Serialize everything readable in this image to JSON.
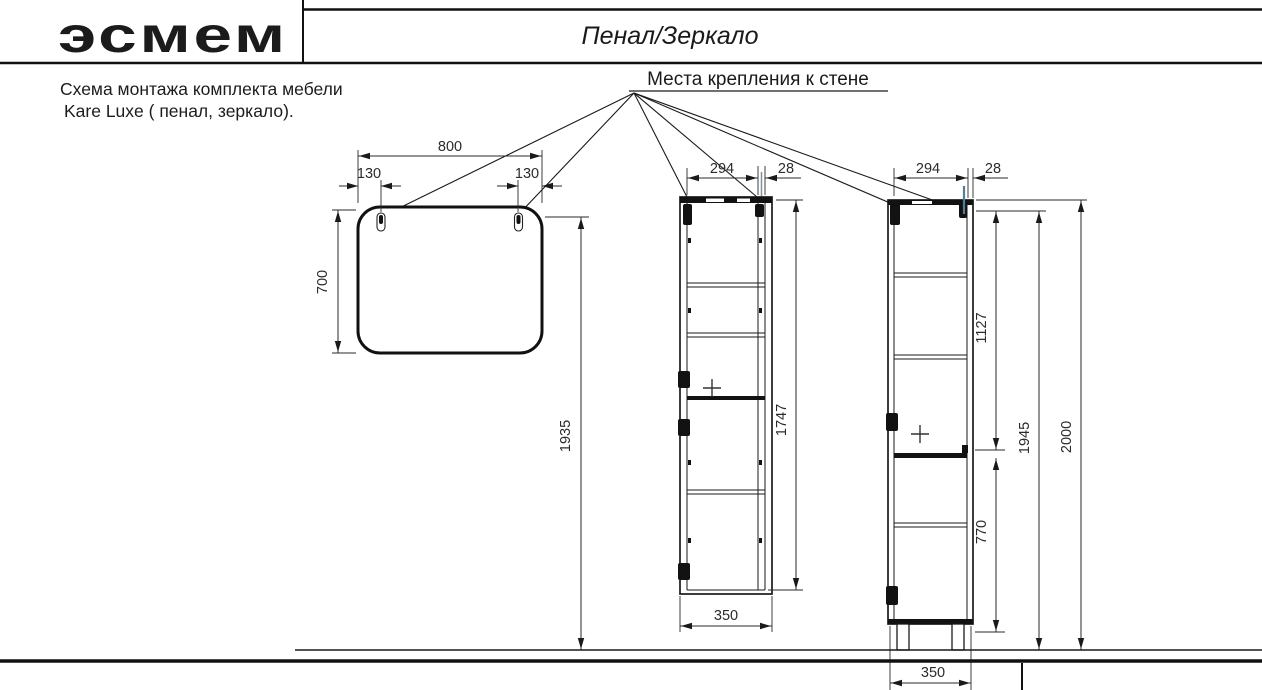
{
  "header": {
    "logo": "эсмем",
    "title": "Пенал/Зеркало"
  },
  "note": {
    "line1": "Схема монтажа комплекта мебели",
    "line2": "Kare Luxe ( пенал, зеркало)."
  },
  "callout": {
    "label": "Места крепления к стене"
  },
  "dims": {
    "mirror": {
      "width": "800",
      "left": "130",
      "right": "130",
      "height": "700",
      "mount": "1935"
    },
    "side": {
      "inner": "294",
      "panel": "28",
      "height": "1747",
      "depth": "350"
    },
    "front": {
      "inner": "294",
      "panel": "28",
      "upper": "1127",
      "lower": "770",
      "body": "1945",
      "total": "2000",
      "width": "350"
    }
  },
  "colors": {
    "line": "#1a1a1a",
    "accent": "#4d7f99",
    "text": "#2b2b2b"
  }
}
